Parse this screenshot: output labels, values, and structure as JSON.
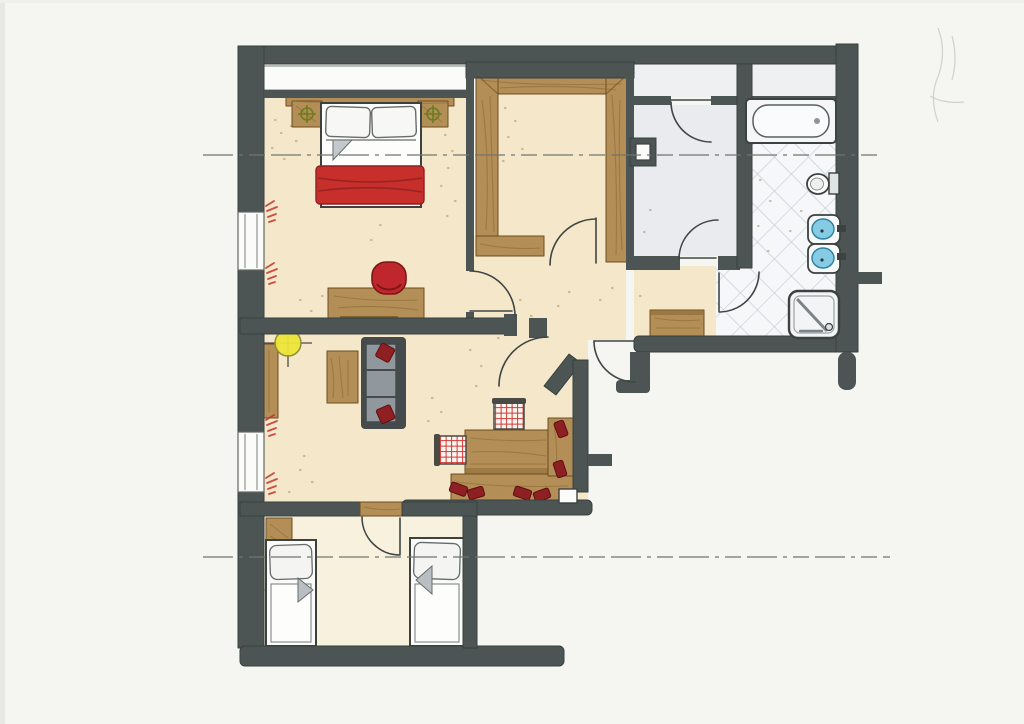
{
  "document": {
    "kind": "hand-drawn apartment floor plan",
    "medium": "marker and ink sketch on white paper",
    "orientation": "landscape",
    "visible_text": ""
  },
  "palette": {
    "paper": "#f5f5f1",
    "wall": "#4c5553",
    "wall-edge": "#39413f",
    "line": "#3f4644",
    "dash": "#70756f",
    "beige": "#f5e8ca",
    "pale": "#f8f1de",
    "gray-floor": "#e9ebee",
    "strip-floor": "#eef0f2",
    "tile-bg": "#f5f7f9",
    "tile-line": "#c9cfd8",
    "wood": "#b38e57",
    "wood-grain": "#8a6732",
    "wood-edge": "#6b4e22",
    "red": "#c62f2a",
    "red-dark": "#8e1f22",
    "red-deep": "#5e1012",
    "sofa-frame": "#454b4d",
    "sofa-cushion": "#90989d",
    "blue": "#85cbe4",
    "blue-dark": "#2f7fa0",
    "yellow": "#efe539",
    "green": "#6c7c1e",
    "white": "#fbfbfa",
    "gray-object": "#c3c8cc",
    "speckle": "#9c8a5e",
    "pencil": "#c5c8c4"
  },
  "rooms": [
    {
      "id": "bedroom",
      "name": "bedroom",
      "furniture": [
        "double bed with two pillows and red blanket",
        "headboard shelf",
        "two nightstands with reading-lamp symbols",
        "desk",
        "red chair"
      ]
    },
    {
      "id": "walk-in-closet",
      "name": "walk-in closet",
      "furniture": [
        "U-shaped wooden wardrobe"
      ]
    },
    {
      "id": "corridor",
      "name": "corridor",
      "furniture": [
        "service shaft box"
      ]
    },
    {
      "id": "entry-hall",
      "name": "entry hall",
      "furniture": [
        "wooden sideboard chest"
      ]
    },
    {
      "id": "bathroom",
      "name": "bathroom",
      "furniture": [
        "bathtub",
        "toilet",
        "two blue washbasins",
        "shower cabin"
      ],
      "floor": "diagonal tile lattice"
    },
    {
      "id": "living-dining",
      "name": "living / dining room",
      "furniture": [
        "gray sofa with two red cushions",
        "coffee table",
        "wall-side shelf",
        "yellow ceiling-lamp symbol",
        "dining table",
        "L-shaped corner bench with red cushions",
        "two red-checkered chairs"
      ]
    },
    {
      "id": "kids-room",
      "name": "children's room",
      "furniture": [
        "two single beds with pillows",
        "bedside cabinet",
        "wooden door lintel"
      ]
    }
  ],
  "annotations": {
    "section_lines": 2,
    "door_swings": 8,
    "windows": 3,
    "plant_scribbles": 4
  }
}
